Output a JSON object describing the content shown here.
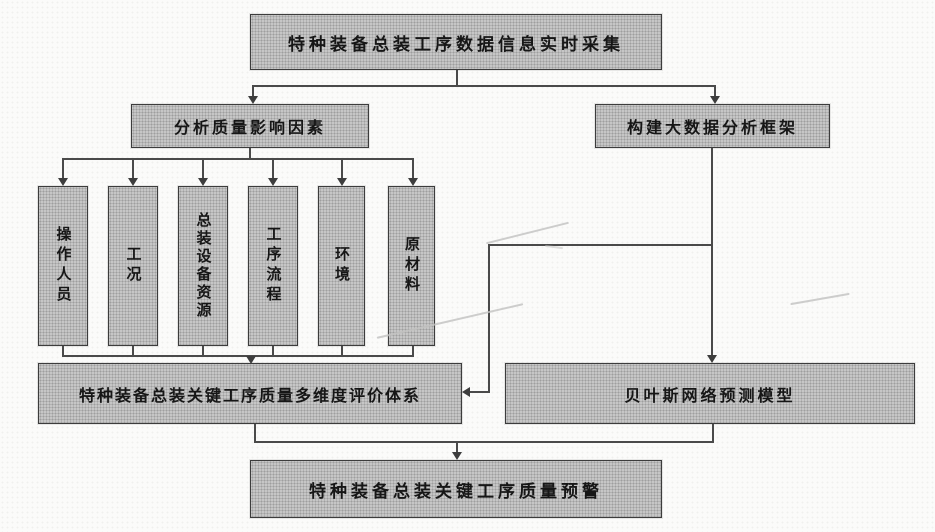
{
  "palette": {
    "background": "#fbfbfa",
    "box_fill": "#c6c6c6",
    "box_border": "#3c3c3c",
    "connector_line": "#4a4a4a",
    "text": "#161616"
  },
  "flowchart": {
    "collect": {
      "label": "特种装备总装工序数据信息实时采集"
    },
    "analyze": {
      "label": "分析质量影响因素"
    },
    "framework": {
      "label": "构建大数据分析框架"
    },
    "factors": [
      {
        "label": "操作人员"
      },
      {
        "label": "工况"
      },
      {
        "label": "总装设备资源"
      },
      {
        "label": "工序流程"
      },
      {
        "label": "环境"
      },
      {
        "label": "原材料"
      }
    ],
    "evaluation": {
      "label": "特种装备总装关键工序质量多维度评价体系"
    },
    "bayes": {
      "label": "贝叶斯网络预测模型"
    },
    "warning": {
      "label": "特种装备总装关键工序质量预警"
    }
  }
}
